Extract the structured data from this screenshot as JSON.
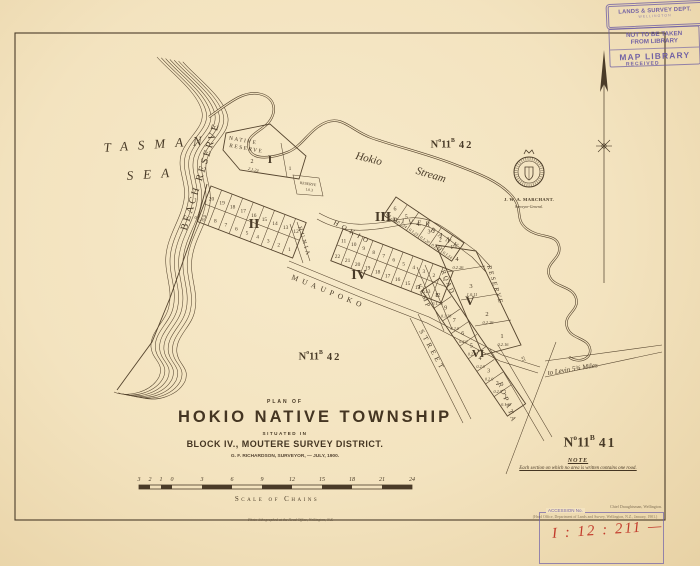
{
  "sheet": {
    "imprint": "Photo-lithographed at the Head Office, Wellington, N.Z."
  },
  "sea": {
    "line1": "TASMAN",
    "line2": "SEA"
  },
  "stream_label": {
    "word1": "Hokio",
    "word2": "Stream"
  },
  "reserves": {
    "beach": "BEACH RESERVE",
    "native_line1": "NATIVE",
    "native_line2": "RESERVE",
    "small_reserve": "RESERVE",
    "small_reserve_area": "1.0.3",
    "stream_reserve": "RESERVE"
  },
  "roads": {
    "hokio": "HOKIO",
    "river": "RIVER",
    "bank": "BANK",
    "hunia": "HUNIA",
    "muaupoko": "MUAUPOKO",
    "kemp": "KEMP",
    "road": "ROAD",
    "kemp_st": "ST",
    "street": "STREET",
    "ropata": "ROPATA",
    "ropata_st": "ST",
    "levin": "to Levin 5¾ Miles"
  },
  "refs": {
    "n": "N",
    "o": "o",
    "num": "11",
    "b": "B",
    "top_num": "42",
    "mid_num": "42",
    "right_num": "41"
  },
  "blocks": {
    "I": {
      "label": "I",
      "n2": "2",
      "area2": "2.1.23",
      "n1": "1"
    },
    "II": {
      "label": "II",
      "top": [
        "20",
        "19",
        "18",
        "17",
        "16",
        "15",
        "14",
        "13",
        "12"
      ],
      "bottom": [
        "9",
        "8",
        "7",
        "6",
        "5",
        "4",
        "3",
        "2",
        "1"
      ],
      "area_note": "0.1.20"
    },
    "III": {
      "label": "III",
      "sections": [
        {
          "n": "6",
          "area": "0.1.26"
        },
        {
          "n": "5",
          "area": "0.1.24"
        },
        {
          "n": "4",
          "area": "0.1.23"
        },
        {
          "n": "3",
          "area": "0.1.20"
        },
        {
          "n": "2",
          "area": "0.1.13"
        },
        {
          "n": "1",
          "area": "0.1.14"
        }
      ]
    },
    "IV": {
      "label": "IV",
      "top": [
        "11",
        "10",
        "9",
        "8",
        "7",
        "6",
        "5",
        "4",
        "3",
        "2",
        "1"
      ],
      "bottom": [
        "22",
        "21",
        "20",
        "19",
        "18",
        "17",
        "16",
        "15",
        "14",
        "13",
        "12"
      ]
    },
    "V": {
      "label": "V",
      "sections": [
        {
          "n": "4",
          "area": "0.2.26"
        },
        {
          "n": "3",
          "area": "1.0.11"
        },
        {
          "n": "2",
          "area": "0.2.26"
        },
        {
          "n": "1",
          "area": "0.2.16"
        }
      ]
    },
    "VI": {
      "label": "VI",
      "sections": [
        {
          "n": "8",
          "area": "0.1.33"
        },
        {
          "n": "9",
          "area": "0.1.28"
        },
        {
          "n": "7",
          "area": "0.2.0"
        },
        {
          "n": "6",
          "area": "0.2.0"
        },
        {
          "n": "5",
          "area": "0.2.0"
        },
        {
          "n": "4",
          "area": "0.2.0"
        },
        {
          "n": "3",
          "area": "0.2.0"
        },
        {
          "n": "2",
          "area": "0.2.0"
        },
        {
          "n": "1",
          "area": "0.1.37"
        }
      ]
    }
  },
  "seal": {
    "name": "J. W. A. MARCHANT.",
    "title": "Surveyor-General."
  },
  "title_block": {
    "plan_of": "PLAN OF",
    "title": "HOKIO NATIVE TOWNSHIP",
    "situated_in": "SITUATED IN",
    "district": "BLOCK IV., MOUTERE SURVEY DISTRICT.",
    "surveyor": "G. F. RICHARDSON, SURVEYOR, — JULY, 1900."
  },
  "note": {
    "heading": "NOTE",
    "text": "Each section on which no area is written contains one rood."
  },
  "scale_bar": {
    "caption": "Scale of Chains",
    "left_ticks": [
      "3",
      "2",
      "1",
      "0"
    ],
    "main_ticks": [
      "3",
      "6",
      "9",
      "12",
      "15",
      "18",
      "21",
      "24"
    ]
  },
  "stamps": {
    "dept": "LANDS & SURVEY DEPT.",
    "dept_sub": "WELLINGTON",
    "line1": "NOT TO BE TAKEN",
    "line2": "FROM LIBRARY",
    "map_library": "MAP LIBRARY",
    "received": "RECEIVED",
    "accession_label": "ACCESSION No.",
    "accession_value": "I : 12 : 211 —",
    "print_right": "Chief Draughtsman, Wellington.",
    "print_office": "(Head Office, Department of Lands and Survey, Wellington, N.Z., January, 1901.)"
  },
  "colors": {
    "ink": "#483a27",
    "stamp_purple": "#6858a3",
    "accession_red": "#c23a2b",
    "paper": "#f3e3bf"
  }
}
